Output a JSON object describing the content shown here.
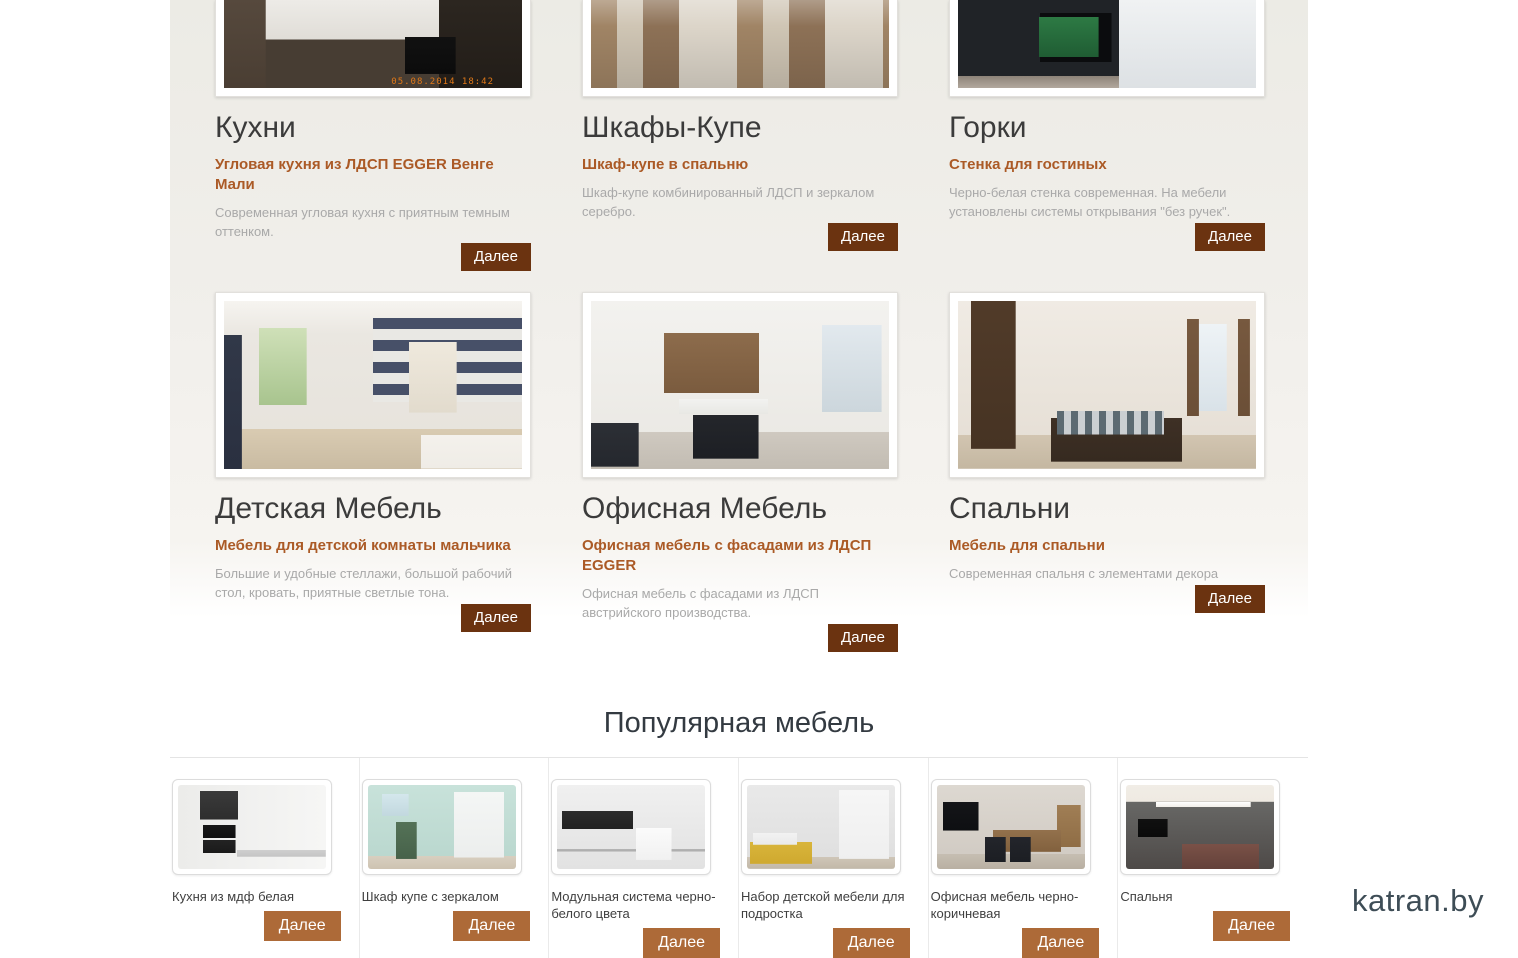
{
  "site": {
    "logo": "katran.by"
  },
  "ui": {
    "more_label": "Далее"
  },
  "colors": {
    "button_dark_brown": "#6b3310",
    "button_light_brown": "#ad6a38",
    "subtitle_brown": "#ab5a26",
    "heading_gray": "#3b3b3b",
    "description_gray": "#a9a9a9",
    "logo_slate": "#3e4d56",
    "top_band_beige": "#efede8"
  },
  "categories": [
    {
      "title": "Кухни",
      "subtitle": "Угловая кухня из ЛДСП EGGER Венге Мали",
      "description": "Современная угловая кухня с приятным темным оттенком.",
      "photo_timestamp": "05.08.2014 18:42"
    },
    {
      "title": "Шкафы-Купе",
      "subtitle": "Шкаф-купе в спальню",
      "description": "Шкаф-купе комбинированный ЛДСП и зеркалом серебро."
    },
    {
      "title": "Горки",
      "subtitle": "Стенка для гостиных",
      "description": "Черно-белая стенка современная. На мебели установлены системы открывания \"без ручек\"."
    },
    {
      "title": "Детская Мебель",
      "subtitle": "Мебель для детской комнаты мальчика",
      "description": "Большие и удобные стеллажи, большой рабочий стол, кровать, приятные светлые тона."
    },
    {
      "title": "Офисная Мебель",
      "subtitle": "Офисная мебель с фасадами из ЛДСП EGGER",
      "description": "Офисная мебель с фасадами из ЛДСП австрийского производства."
    },
    {
      "title": "Спальни",
      "subtitle": "Мебель для спальни",
      "description": "Современная спальня с элементами декора"
    }
  ],
  "popular": {
    "heading": "Популярная мебель",
    "items": [
      {
        "caption": "Кухня из мдф белая"
      },
      {
        "caption": "Шкаф купе с зеркалом"
      },
      {
        "caption": "Модульная система черно-белого цвета"
      },
      {
        "caption": "Набор детской мебели для подростка"
      },
      {
        "caption": "Офисная мебель черно-коричневая"
      },
      {
        "caption": "Спальня"
      }
    ]
  }
}
